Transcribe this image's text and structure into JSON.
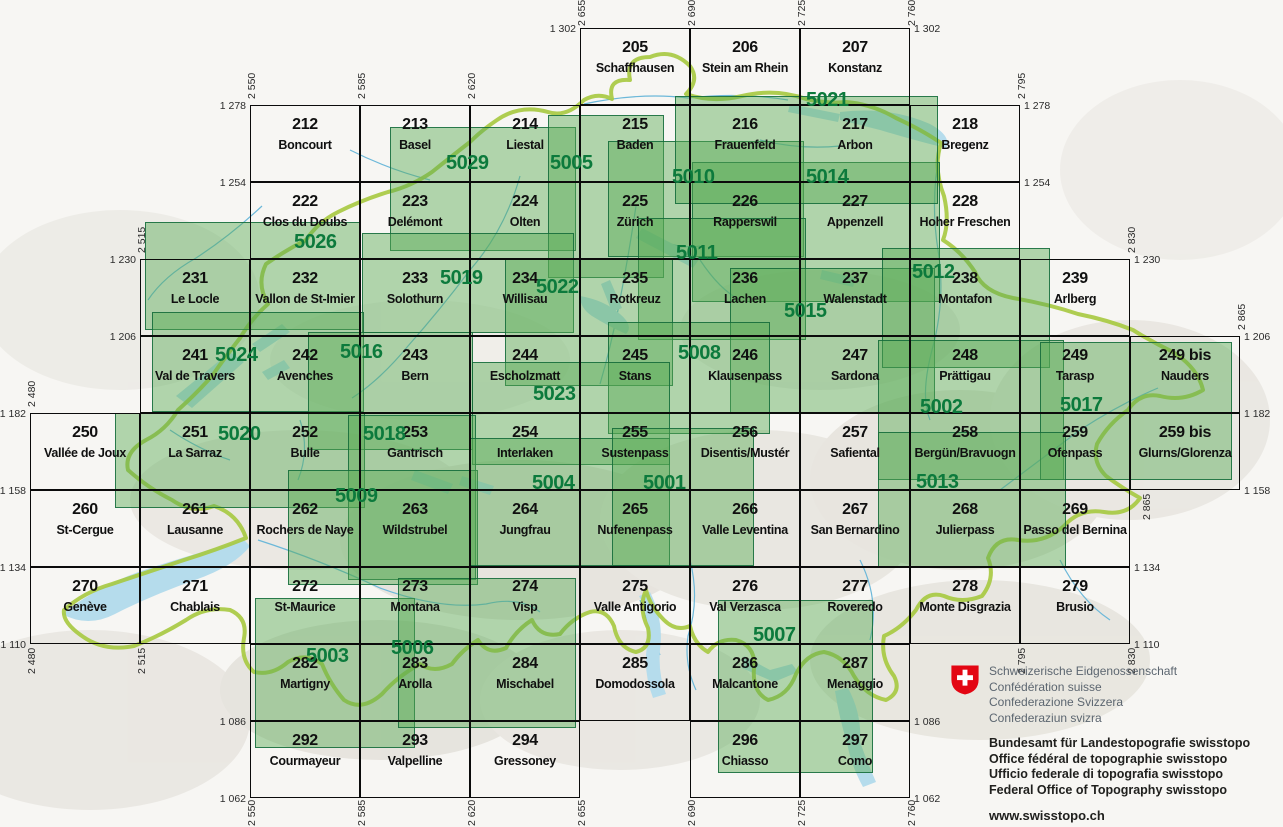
{
  "colors": {
    "composite_green": "#0c7a3c",
    "overlay_fill": "rgba(88,170,85,0.45)",
    "overlay_border": "#106838",
    "grid_line": "#0b0b0b",
    "lake_blue": "#b5dcec",
    "river_blue": "#6cb8d9",
    "country_border_green": "#a6c93f",
    "relief_bg": "#f7f6f3",
    "logo_red": "#e30613"
  },
  "sheets": [
    {
      "number": "205",
      "name": "Schaffhausen",
      "e": 2655,
      "n": 1302
    },
    {
      "number": "206",
      "name": "Stein am Rhein",
      "e": 2690,
      "n": 1302
    },
    {
      "number": "207",
      "name": "Konstanz",
      "e": 2725,
      "n": 1302
    },
    {
      "number": "212",
      "name": "Boncourt",
      "e": 2550,
      "n": 1278
    },
    {
      "number": "213",
      "name": "Basel",
      "e": 2585,
      "n": 1278
    },
    {
      "number": "214",
      "name": "Liestal",
      "e": 2620,
      "n": 1278
    },
    {
      "number": "215",
      "name": "Baden",
      "e": 2655,
      "n": 1278
    },
    {
      "number": "216",
      "name": "Frauenfeld",
      "e": 2690,
      "n": 1278
    },
    {
      "number": "217",
      "name": "Arbon",
      "e": 2725,
      "n": 1278
    },
    {
      "number": "218",
      "name": "Bregenz",
      "e": 2760,
      "n": 1278
    },
    {
      "number": "222",
      "name": "Clos du Doubs",
      "e": 2550,
      "n": 1254
    },
    {
      "number": "223",
      "name": "Delémont",
      "e": 2585,
      "n": 1254
    },
    {
      "number": "224",
      "name": "Olten",
      "e": 2620,
      "n": 1254
    },
    {
      "number": "225",
      "name": "Zürich",
      "e": 2655,
      "n": 1254
    },
    {
      "number": "226",
      "name": "Rapperswil",
      "e": 2690,
      "n": 1254
    },
    {
      "number": "227",
      "name": "Appenzell",
      "e": 2725,
      "n": 1254
    },
    {
      "number": "228",
      "name": "Hoher Freschen",
      "e": 2760,
      "n": 1254
    },
    {
      "number": "231",
      "name": "Le Locle",
      "e": 2515,
      "n": 1230
    },
    {
      "number": "232",
      "name": "Vallon de St-Imier",
      "e": 2550,
      "n": 1230
    },
    {
      "number": "233",
      "name": "Solothurn",
      "e": 2585,
      "n": 1230
    },
    {
      "number": "234",
      "name": "Willisau",
      "e": 2620,
      "n": 1230
    },
    {
      "number": "235",
      "name": "Rotkreuz",
      "e": 2655,
      "n": 1230
    },
    {
      "number": "236",
      "name": "Lachen",
      "e": 2690,
      "n": 1230
    },
    {
      "number": "237",
      "name": "Walenstadt",
      "e": 2725,
      "n": 1230
    },
    {
      "number": "238",
      "name": "Montafon",
      "e": 2760,
      "n": 1230
    },
    {
      "number": "239",
      "name": "Arlberg",
      "e": 2795,
      "n": 1230
    },
    {
      "number": "241",
      "name": "Val de Travers",
      "e": 2515,
      "n": 1206
    },
    {
      "number": "242",
      "name": "Avenches",
      "e": 2550,
      "n": 1206
    },
    {
      "number": "243",
      "name": "Bern",
      "e": 2585,
      "n": 1206
    },
    {
      "number": "244",
      "name": "Escholzmatt",
      "e": 2620,
      "n": 1206
    },
    {
      "number": "245",
      "name": "Stans",
      "e": 2655,
      "n": 1206
    },
    {
      "number": "246",
      "name": "Klausenpass",
      "e": 2690,
      "n": 1206
    },
    {
      "number": "247",
      "name": "Sardona",
      "e": 2725,
      "n": 1206
    },
    {
      "number": "248",
      "name": "Prättigau",
      "e": 2760,
      "n": 1206
    },
    {
      "number": "249",
      "name": "Tarasp",
      "e": 2795,
      "n": 1206
    },
    {
      "number": "249 bis",
      "name": "Nauders",
      "e": 2830,
      "n": 1206
    },
    {
      "number": "250",
      "name": "Vallée de Joux",
      "e": 2480,
      "n": 1182
    },
    {
      "number": "251",
      "name": "La Sarraz",
      "e": 2515,
      "n": 1182
    },
    {
      "number": "252",
      "name": "Bulle",
      "e": 2550,
      "n": 1182
    },
    {
      "number": "253",
      "name": "Gantrisch",
      "e": 2585,
      "n": 1182
    },
    {
      "number": "254",
      "name": "Interlaken",
      "e": 2620,
      "n": 1182
    },
    {
      "number": "255",
      "name": "Sustenpass",
      "e": 2655,
      "n": 1182
    },
    {
      "number": "256",
      "name": "Disentis/Mustér",
      "e": 2690,
      "n": 1182
    },
    {
      "number": "257",
      "name": "Safiental",
      "e": 2725,
      "n": 1182
    },
    {
      "number": "258",
      "name": "Bergün/Bravuogn",
      "e": 2760,
      "n": 1182
    },
    {
      "number": "259",
      "name": "Ofenpass",
      "e": 2795,
      "n": 1182
    },
    {
      "number": "259 bis",
      "name": "Glurns/Glorenza",
      "e": 2830,
      "n": 1182
    },
    {
      "number": "260",
      "name": "St-Cergue",
      "e": 2480,
      "n": 1158
    },
    {
      "number": "261",
      "name": "Lausanne",
      "e": 2515,
      "n": 1158
    },
    {
      "number": "262",
      "name": "Rochers de Naye",
      "e": 2550,
      "n": 1158
    },
    {
      "number": "263",
      "name": "Wildstrubel",
      "e": 2585,
      "n": 1158
    },
    {
      "number": "264",
      "name": "Jungfrau",
      "e": 2620,
      "n": 1158
    },
    {
      "number": "265",
      "name": "Nufenenpass",
      "e": 2655,
      "n": 1158
    },
    {
      "number": "266",
      "name": "Valle Leventina",
      "e": 2690,
      "n": 1158
    },
    {
      "number": "267",
      "name": "San Bernardino",
      "e": 2725,
      "n": 1158
    },
    {
      "number": "268",
      "name": "Julierpass",
      "e": 2760,
      "n": 1158
    },
    {
      "number": "269",
      "name": "Passo del Bernina",
      "e": 2795,
      "n": 1158
    },
    {
      "number": "270",
      "name": "Genève",
      "e": 2480,
      "n": 1134
    },
    {
      "number": "271",
      "name": "Chablais",
      "e": 2515,
      "n": 1134
    },
    {
      "number": "272",
      "name": "St-Maurice",
      "e": 2550,
      "n": 1134
    },
    {
      "number": "273",
      "name": "Montana",
      "e": 2585,
      "n": 1134
    },
    {
      "number": "274",
      "name": "Visp",
      "e": 2620,
      "n": 1134
    },
    {
      "number": "275",
      "name": "Valle Antigorio",
      "e": 2655,
      "n": 1134
    },
    {
      "number": "276",
      "name": "Val Verzasca",
      "e": 2690,
      "n": 1134
    },
    {
      "number": "277",
      "name": "Roveredo",
      "e": 2725,
      "n": 1134
    },
    {
      "number": "278",
      "name": "Monte Disgrazia",
      "e": 2760,
      "n": 1134
    },
    {
      "number": "279",
      "name": "Brusio",
      "e": 2795,
      "n": 1134
    },
    {
      "number": "282",
      "name": "Martigny",
      "e": 2550,
      "n": 1110
    },
    {
      "number": "283",
      "name": "Arolla",
      "e": 2585,
      "n": 1110
    },
    {
      "number": "284",
      "name": "Mischabel",
      "e": 2620,
      "n": 1110
    },
    {
      "number": "285",
      "name": "Domodossola",
      "e": 2655,
      "n": 1110
    },
    {
      "number": "286",
      "name": "Malcantone",
      "e": 2690,
      "n": 1110
    },
    {
      "number": "287",
      "name": "Menaggio",
      "e": 2725,
      "n": 1110
    },
    {
      "number": "292",
      "name": "Courmayeur",
      "e": 2550,
      "n": 1086
    },
    {
      "number": "293",
      "name": "Valpelline",
      "e": 2585,
      "n": 1086
    },
    {
      "number": "294",
      "name": "Gressoney",
      "e": 2620,
      "n": 1086
    },
    {
      "number": "296",
      "name": "Chiasso",
      "e": 2690,
      "n": 1086
    },
    {
      "number": "297",
      "name": "Como",
      "e": 2725,
      "n": 1086
    }
  ],
  "composites": [
    {
      "number": "5029",
      "x": 390,
      "y": 127,
      "w": 186,
      "h": 124,
      "lx": 446,
      "ly": 153
    },
    {
      "number": "5005",
      "x": 548,
      "y": 115,
      "w": 116,
      "h": 163,
      "lx": 550,
      "ly": 153
    },
    {
      "number": "5010",
      "x": 608,
      "y": 141,
      "w": 196,
      "h": 116,
      "lx": 672,
      "ly": 167
    },
    {
      "number": "5014",
      "x": 692,
      "y": 162,
      "w": 248,
      "h": 140,
      "lx": 806,
      "ly": 167
    },
    {
      "number": "5021",
      "x": 675,
      "y": 96,
      "w": 263,
      "h": 108,
      "lx": 806,
      "ly": 90
    },
    {
      "number": "5011",
      "x": 638,
      "y": 218,
      "w": 168,
      "h": 122,
      "lx": 676,
      "ly": 243
    },
    {
      "number": "5026",
      "x": 145,
      "y": 222,
      "w": 215,
      "h": 108,
      "lx": 294,
      "ly": 232
    },
    {
      "number": "5019",
      "x": 362,
      "y": 233,
      "w": 212,
      "h": 100,
      "lx": 440,
      "ly": 268
    },
    {
      "number": "5022",
      "x": 505,
      "y": 258,
      "w": 168,
      "h": 128,
      "lx": 536,
      "ly": 277
    },
    {
      "number": "5015",
      "x": 730,
      "y": 268,
      "w": 205,
      "h": 145,
      "lx": 784,
      "ly": 301
    },
    {
      "number": "5012",
      "x": 882,
      "y": 248,
      "w": 168,
      "h": 120,
      "lx": 912,
      "ly": 262
    },
    {
      "number": "5024",
      "x": 152,
      "y": 312,
      "w": 212,
      "h": 100,
      "lx": 215,
      "ly": 345
    },
    {
      "number": "5016",
      "x": 308,
      "y": 332,
      "w": 165,
      "h": 118,
      "lx": 340,
      "ly": 342
    },
    {
      "number": "5008",
      "x": 608,
      "y": 322,
      "w": 162,
      "h": 112,
      "lx": 678,
      "ly": 343
    },
    {
      "number": "5023",
      "x": 472,
      "y": 362,
      "w": 198,
      "h": 103,
      "lx": 533,
      "ly": 384
    },
    {
      "number": "5002",
      "x": 878,
      "y": 340,
      "w": 186,
      "h": 140,
      "lx": 920,
      "ly": 397
    },
    {
      "number": "5017",
      "x": 1040,
      "y": 342,
      "w": 192,
      "h": 138,
      "lx": 1060,
      "ly": 395
    },
    {
      "number": "5020",
      "x": 115,
      "y": 413,
      "w": 250,
      "h": 95,
      "lx": 218,
      "ly": 424
    },
    {
      "number": "5018",
      "x": 348,
      "y": 415,
      "w": 128,
      "h": 165,
      "lx": 363,
      "ly": 424
    },
    {
      "number": "5009",
      "x": 288,
      "y": 470,
      "w": 190,
      "h": 115,
      "lx": 335,
      "ly": 486
    },
    {
      "number": "5004",
      "x": 470,
      "y": 438,
      "w": 200,
      "h": 128,
      "lx": 532,
      "ly": 473
    },
    {
      "number": "5001",
      "x": 612,
      "y": 428,
      "w": 142,
      "h": 138,
      "lx": 643,
      "ly": 473
    },
    {
      "number": "5013",
      "x": 878,
      "y": 432,
      "w": 188,
      "h": 136,
      "lx": 916,
      "ly": 472
    },
    {
      "number": "5007",
      "x": 718,
      "y": 600,
      "w": 155,
      "h": 173,
      "lx": 753,
      "ly": 625
    },
    {
      "number": "5003",
      "x": 255,
      "y": 598,
      "w": 160,
      "h": 150,
      "lx": 306,
      "ly": 646
    },
    {
      "number": "5006",
      "x": 398,
      "y": 578,
      "w": 178,
      "h": 150,
      "lx": 391,
      "ly": 638
    }
  ],
  "coordinate_labels": {
    "horizontal": [
      [
        "1 302",
        576,
        28,
        "end"
      ],
      [
        "1 302",
        914,
        28,
        "start"
      ],
      [
        "1 278",
        246,
        105,
        "end"
      ],
      [
        "1 278",
        1024,
        105,
        "start"
      ],
      [
        "1 254",
        246,
        182,
        "end"
      ],
      [
        "1 254",
        1024,
        182,
        "start"
      ],
      [
        "1 230",
        136,
        259,
        "end"
      ],
      [
        "1 230",
        1134,
        259,
        "start"
      ],
      [
        "1 206",
        136,
        336,
        "end"
      ],
      [
        "1 206",
        1244,
        336,
        "start"
      ],
      [
        "1 182",
        26,
        413,
        "end"
      ],
      [
        "1 182",
        1244,
        413,
        "start"
      ],
      [
        "1 158",
        26,
        490,
        "end"
      ],
      [
        "1 158",
        1244,
        490,
        "start"
      ],
      [
        "1 134",
        26,
        567,
        "end"
      ],
      [
        "1 134",
        1134,
        567,
        "start"
      ],
      [
        "1 110",
        26,
        644,
        "end"
      ],
      [
        "1 110",
        1134,
        644,
        "start"
      ],
      [
        "1 086",
        246,
        721,
        "end"
      ],
      [
        "1 086",
        914,
        721,
        "start"
      ],
      [
        "1 062",
        246,
        798,
        "end"
      ],
      [
        "1 062",
        914,
        798,
        "start"
      ]
    ],
    "vertical": [
      [
        "2 655",
        585,
        26
      ],
      [
        "2 690",
        695,
        26
      ],
      [
        "2 725",
        805,
        26
      ],
      [
        "2 760",
        915,
        26
      ],
      [
        "2 550",
        255,
        99
      ],
      [
        "2 585",
        365,
        99
      ],
      [
        "2 620",
        475,
        99
      ],
      [
        "2 795",
        1025,
        99
      ],
      [
        "2 515",
        145,
        253
      ],
      [
        "2 830",
        1135,
        253
      ],
      [
        "2 865",
        1245,
        330
      ],
      [
        "2 480",
        35,
        407
      ],
      [
        "2 480",
        35,
        674
      ],
      [
        "2 515",
        145,
        674
      ],
      [
        "2 795",
        1025,
        674
      ],
      [
        "2 830",
        1135,
        674
      ],
      [
        "2 865",
        1150,
        520
      ],
      [
        "2 550",
        255,
        826
      ],
      [
        "2 585",
        365,
        826
      ],
      [
        "2 620",
        475,
        826
      ],
      [
        "2 655",
        585,
        826
      ],
      [
        "2 690",
        695,
        826
      ],
      [
        "2 725",
        805,
        826
      ],
      [
        "2 760",
        915,
        826
      ]
    ]
  },
  "logo": {
    "confederation": [
      "Schweizerische Eidgenossenschaft",
      "Confédération suisse",
      "Confederazione Svizzera",
      "Confederaziun svizra"
    ],
    "office": [
      "Bundesamt für Landestopografie swisstopo",
      "Office fédéral de topographie swisstopo",
      "Ufficio federale di topografia swisstopo",
      "Federal Office of Topography swisstopo"
    ],
    "website": "www.swisstopo.ch"
  }
}
